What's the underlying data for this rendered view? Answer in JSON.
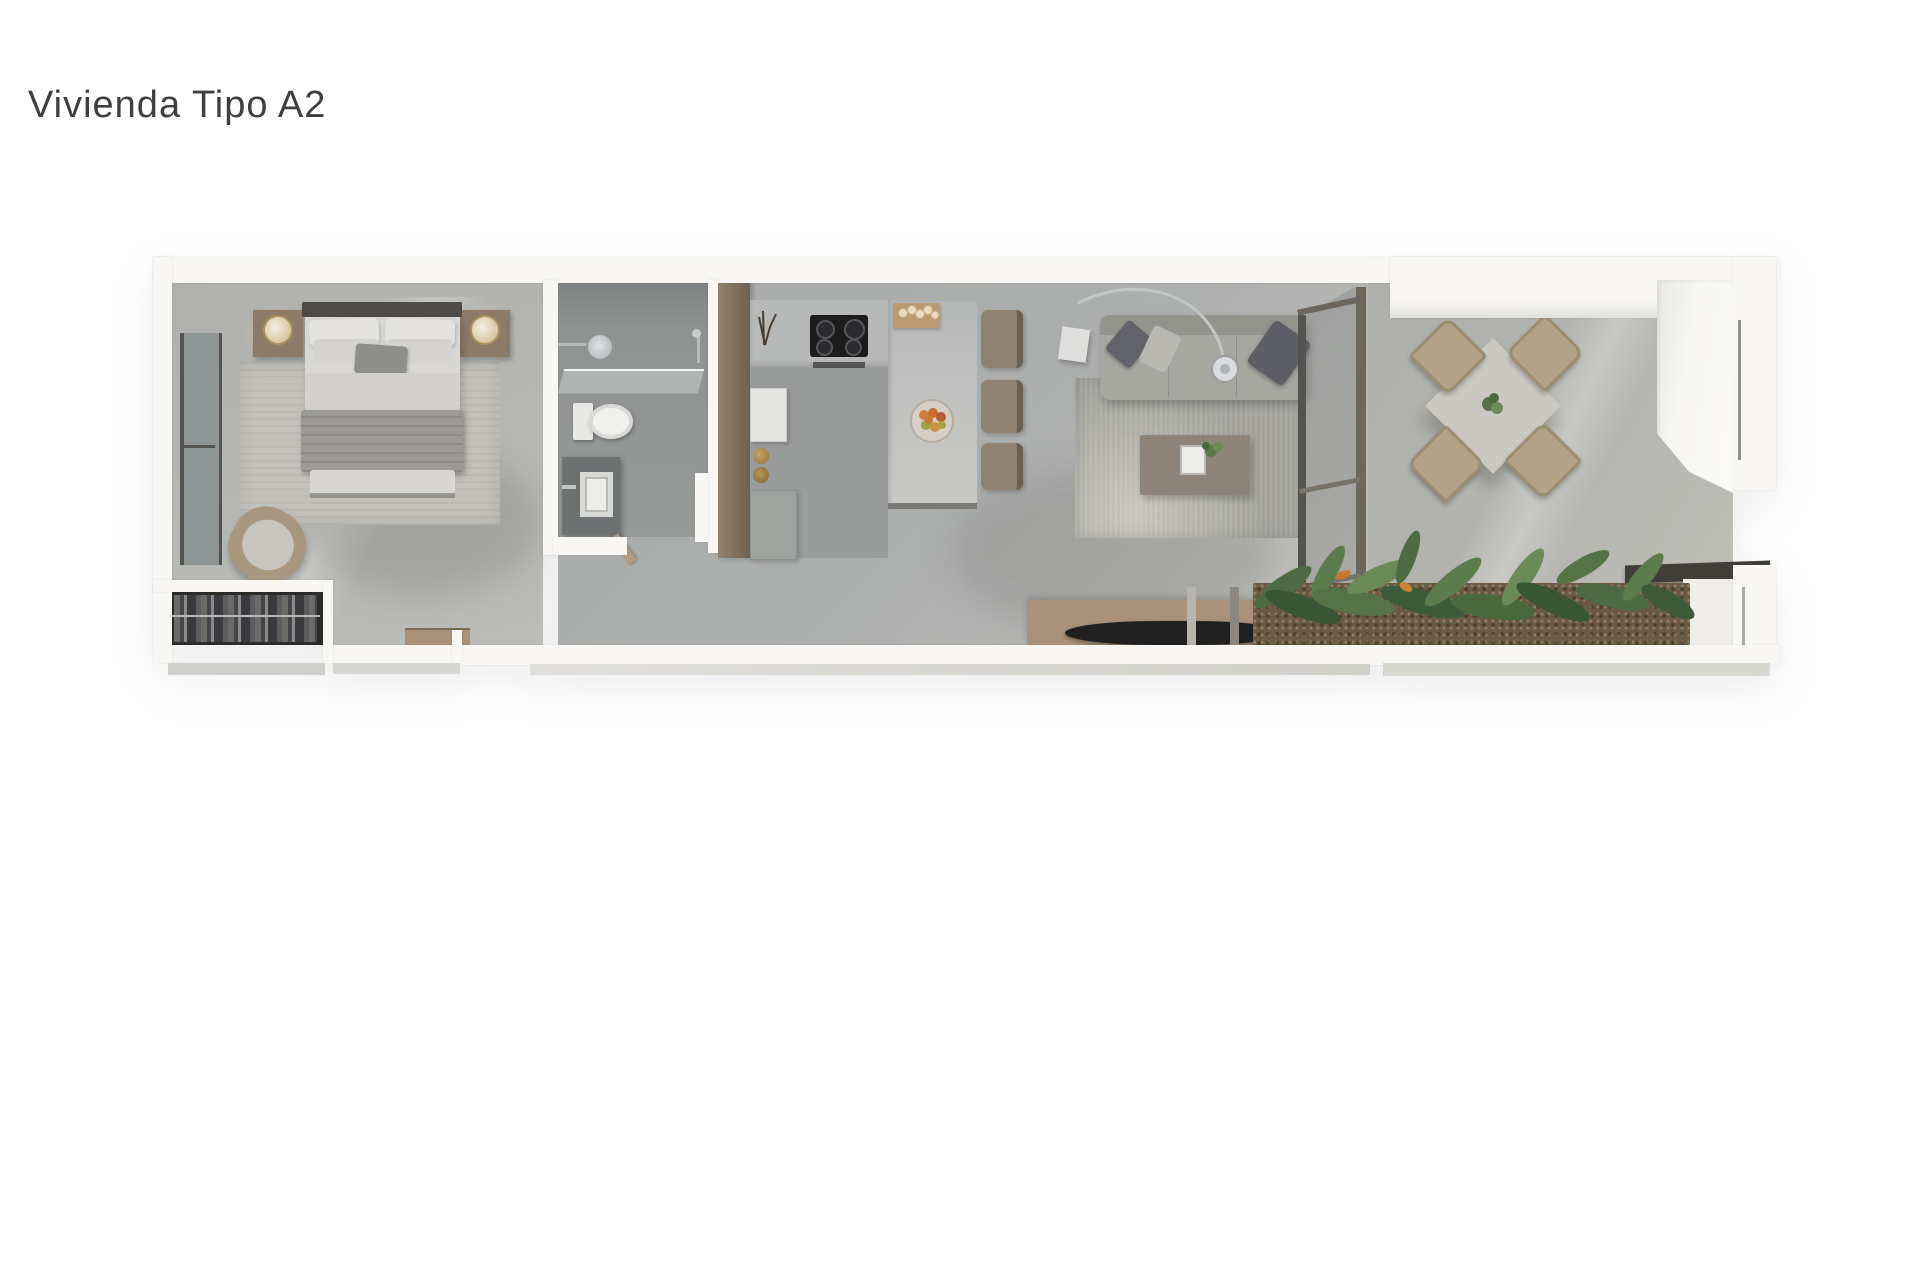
{
  "title": "Vivienda Tipo A2",
  "plan": {
    "view": "3d-top-down-floorplan",
    "rooms": [
      {
        "name": "bedroom",
        "furniture": [
          "double-bed",
          "headboard",
          "pillows",
          "accent-pillow",
          "blanket",
          "area-rug",
          "nightstand-left",
          "nightstand-right",
          "table-lamp-left",
          "table-lamp-right",
          "lounge-chair",
          "wardrobe-closet",
          "window-left-wall"
        ]
      },
      {
        "name": "bathroom",
        "furniture": [
          "shower-head",
          "hand-shower",
          "glass-shower-screen",
          "toilet",
          "vanity-counter",
          "vessel-sink",
          "door-leaf"
        ]
      },
      {
        "name": "kitchen",
        "furniture": [
          "tall-wood-cabinets",
          "l-shaped-counter",
          "island-peninsula",
          "cooktop",
          "cutting-board-with-bread",
          "fruit-bowl",
          "fridge-top",
          "canisters",
          "low-cabinet",
          "branch-decor",
          "bar-stool-1",
          "bar-stool-2",
          "bar-stool-3",
          "door-leaf"
        ]
      },
      {
        "name": "living-room",
        "furniture": [
          "sofa",
          "cushion-dark-left",
          "cushion-light",
          "cushion-dark-right",
          "arc-floor-lamp",
          "side-table",
          "coffee-table",
          "tray",
          "small-plant",
          "area-rug",
          "tv-console",
          "tv"
        ]
      },
      {
        "name": "dining-terrace",
        "furniture": [
          "glass-partition",
          "square-dining-table",
          "center-plant",
          "dining-chair-tl",
          "dining-chair-tr",
          "dining-chair-bl",
          "dining-chair-br",
          "white-service-volume",
          "outdoor-dark-counter",
          "white-outdoor-cabinet",
          "planter-bed",
          "tropical-plants"
        ]
      },
      {
        "name": "hallway",
        "furniture": [
          "small-wood-desk"
        ]
      }
    ]
  },
  "colors": {
    "bg": "#ffffff",
    "ink": "#3f3f3f",
    "wall": "#f8f7f4",
    "wall_shade": "#e2e1dd",
    "floor_bedroom": "#b5b6b3",
    "floor_bath": "#8f9291",
    "floor_main": "#a9abaa",
    "floor_terrace": "#b3b4af",
    "wood": "#8d7b69",
    "wood_light": "#a9917a",
    "counter": "#b7b9b8",
    "dark": "#2c2c2b",
    "sofa": "#a7a7a2",
    "rug_bed": "#c3c1bb",
    "rug_living": "#a2a19b",
    "tv": "#202021",
    "counter_dark": "#413e3a",
    "planter": "#6b5a43",
    "plant": "#567247",
    "chrome": "#c9cccd",
    "white_obj": "#ececea"
  }
}
